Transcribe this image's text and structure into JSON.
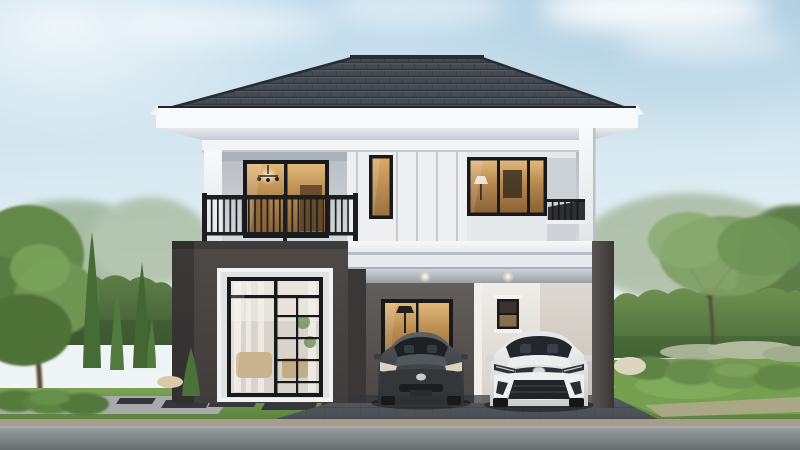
{
  "scene": {
    "type": "architectural-exterior-render",
    "description": "Front elevation of a modern two-story detached house at dusk-lit daytime: dark hipped tile roof with wide white eaves, white upper floor with black-framed windows lit warmly from inside, balcony with black metal railing, charcoal accent wall on the ground floor with a large living-room window, open double carport with two parked cars, landscaped garden with hedges, cypress and shade trees, lawn, paved walkway and road",
    "objects": {
      "house": [
        "hip-tile-roof",
        "eave-fascia",
        "balcony-sliding-door",
        "balcony-railing",
        "stair-slot-window",
        "upper-right-window",
        "side-terrace-railing",
        "floor-slab",
        "charcoal-accent-wall",
        "living-room-window",
        "carport",
        "carport-window",
        "carport-service-window",
        "carport-column"
      ],
      "vehicles": [
        {
          "name": "dark-gray-hatchback",
          "body_color": "#3f4347"
        },
        {
          "name": "white-compact-suv",
          "body_color": "#eef0ef"
        }
      ],
      "landscape": [
        "large-shade-tree",
        "cypress-trees",
        "boxwood-hedge",
        "trimmed-shrubs",
        "lavender-bed",
        "lawn",
        "paver-walkway",
        "stepping-tiles",
        "driveway",
        "asphalt-road"
      ]
    },
    "lighting": {
      "interior_glow": "#c59a61",
      "downlights_on": true
    }
  },
  "palette": {
    "sky_top": "#bcd8e9",
    "sky_mid": "#ddecf3",
    "sky_low": "#f1f5f6",
    "cloud": "#ffffff",
    "roof_base": "#3c4249",
    "roof_line": "#2a2f35",
    "roof_edge": "#22262a",
    "fascia_white": "#f7f9fa",
    "soffit": "#d8dee3",
    "trim_white": "#f0f2f4",
    "wall_recess": "#c6ccd1",
    "wall_panel": "#edeff1",
    "wall_right": "#e6e9eb",
    "frame_black": "#17191b",
    "railing_black": "#1c1e20",
    "glass_warm": "#c59a61",
    "glass_warm_dark": "#8a6236",
    "glass_hi": "#e2b87a",
    "slab_white": "#f2f4f5",
    "slab_shadow": "#b6bec5",
    "wing_dark": "#474443",
    "wing_side": "#3a3837",
    "carport_wall": "#575351",
    "carport_white": "#e9e6e1",
    "ceiling_gray": "#b9c0c6",
    "column_dark": "#4a4645",
    "grass": "#6f9a4c",
    "grass_dark": "#517539",
    "lawn_bright": "#7cab57",
    "hedge_left": "#5c7c45",
    "hedge_right": "#66884a",
    "hedge_dark": "#425e33",
    "tree_green": "#64894a",
    "tree_light": "#7ba45c",
    "cypress": "#4a6f38",
    "trunk_brown": "#5c4b38",
    "far_tree": "#90a884",
    "walkway": "#a9abaa",
    "tile_dark": "#35383b",
    "driveway": "#4e5257",
    "road": "#8f9496",
    "road_dark": "#6d7275",
    "curb": "#a79d8d",
    "gravel": "#b3a88f",
    "car_dark": "#3f4347",
    "car_dark_hi": "#585d62",
    "car_white": "#eef0ef",
    "car_white_shade": "#cfd3d2",
    "car_glass": "#22262a",
    "light_warm": "#f5e9cf"
  }
}
